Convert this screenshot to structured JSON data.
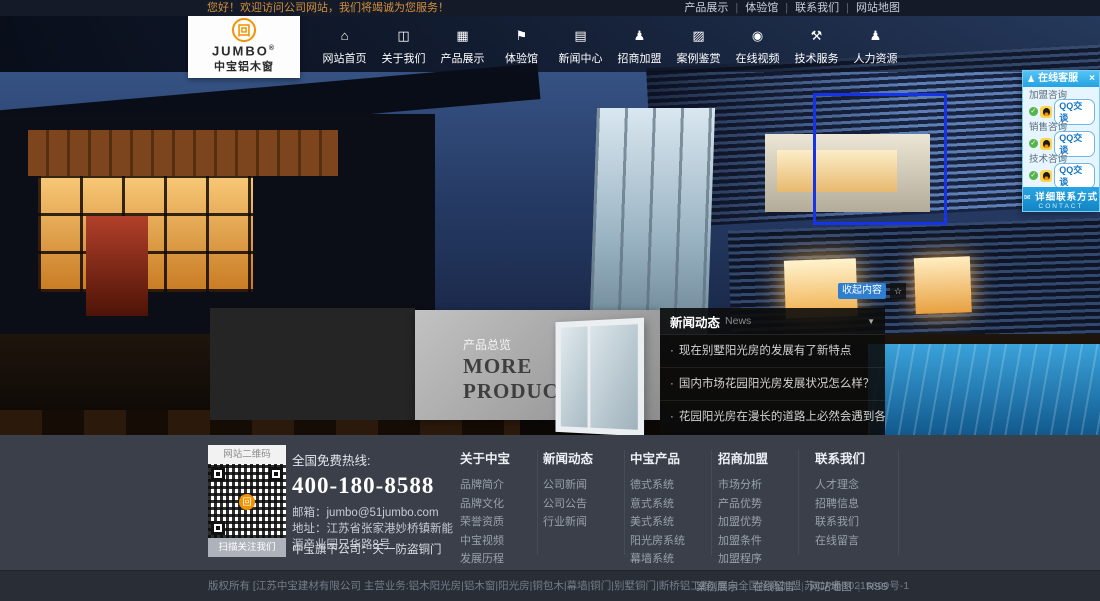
{
  "colors": {
    "accent_blue": "#2f7fd1",
    "qq_blue": "#29a8e0",
    "brand_orange": "#f29200",
    "footer_bg": "#3a3f49"
  },
  "topbar": {
    "welcome": "您好！欢迎访问公司网站，我们将竭诚为您服务！",
    "links": [
      "产品展示",
      "体验馆",
      "联系我们",
      "网站地图"
    ]
  },
  "logo": {
    "mark": "回",
    "brand": "JUMBO",
    "reg": "®",
    "sub": "中宝铝木窗"
  },
  "nav": {
    "items": [
      {
        "label": "网站首页",
        "icon": "⌂",
        "name": "home-icon"
      },
      {
        "label": "关于我们",
        "icon": "◫",
        "name": "about-icon"
      },
      {
        "label": "产品展示",
        "icon": "▦",
        "name": "products-icon"
      },
      {
        "label": "体验馆",
        "icon": "⚑",
        "name": "experience-hall-icon"
      },
      {
        "label": "新闻中心",
        "icon": "▤",
        "name": "news-icon"
      },
      {
        "label": "招商加盟",
        "icon": "♟",
        "name": "join-icon"
      },
      {
        "label": "案例鉴赏",
        "icon": "▨",
        "name": "cases-icon"
      },
      {
        "label": "在线视频",
        "icon": "◉",
        "name": "video-icon"
      },
      {
        "label": "技术服务",
        "icon": "⚒",
        "name": "tech-service-icon"
      },
      {
        "label": "人力资源",
        "icon": "♟",
        "name": "hr-icon"
      }
    ]
  },
  "hero": {
    "collapse_label": "收起内容",
    "pin_icon": "☆"
  },
  "products_panel": {
    "subtitle": "产品总览",
    "title_line1": "MORE",
    "title_line2": "PRODUCTS"
  },
  "news": {
    "title": "新闻动态",
    "subtitle": "News",
    "collapse_icon": "▼",
    "items": [
      "现在别墅阳光房的发展有了新特点",
      "国内市场花园阳光房发展状况怎么样？",
      "花园阳光房在漫长的道路上必然会遇到各种挑战"
    ]
  },
  "qq_panel": {
    "person_icon": "♟",
    "title": "在线客服",
    "close_icon": "×",
    "check_icon": "✓",
    "groups": [
      {
        "label": "加盟咨询",
        "button": "QQ交谈"
      },
      {
        "label": "销售咨询",
        "button": "QQ交谈"
      },
      {
        "label": "技术咨询",
        "button": "QQ交谈"
      }
    ],
    "bubble_icon": "✉",
    "footer_label": "详细联系方式",
    "footer_sub": "CONTACT"
  },
  "footer": {
    "qr": {
      "header": "网站二维码",
      "badge": "回",
      "caption": "扫描关注我们"
    },
    "hotline_label": "全国免费热线:",
    "hotline": "400-180-8588",
    "email": "邮箱：jumbo@51jumbo.com",
    "address": "地址：江苏省张家港妙桥镇新能源产业园兄华路8号",
    "subsidiary": "中宝旗下公司：天一防盗铜门",
    "columns": [
      {
        "title": "关于中宝",
        "links": [
          "品牌简介",
          "品牌文化",
          "荣誉资质",
          "中宝视频",
          "发展历程",
          "品牌形象"
        ]
      },
      {
        "title": "新闻动态",
        "links": [
          "公司新闻",
          "公司公告",
          "行业新闻"
        ]
      },
      {
        "title": "中宝产品",
        "links": [
          "德式系统",
          "意式系统",
          "美式系统",
          "阳光房系统",
          "幕墙系统",
          "断桥铝系统"
        ]
      },
      {
        "title": "招商加盟",
        "links": [
          "市场分析",
          "产品优势",
          "加盟优势",
          "加盟条件",
          "加盟程序",
          "加盟留言",
          "申请表下载"
        ]
      },
      {
        "title": "联系我们",
        "links": [
          "人才理念",
          "招聘信息",
          "联系我们",
          "在线留言"
        ]
      }
    ]
  },
  "bottombar": {
    "copyright": "版权所有 [江苏中宝建材有限公司 主营业务:铝木阳光房|铝木窗|阳光房|铜包木|幕墙|铜门|别墅铜门|断桥铝工程],面向全国招商加盟 苏ICP备10215699号-1",
    "links": [
      "案例展示",
      "在线留言",
      "网站地图",
      "RSS"
    ]
  }
}
